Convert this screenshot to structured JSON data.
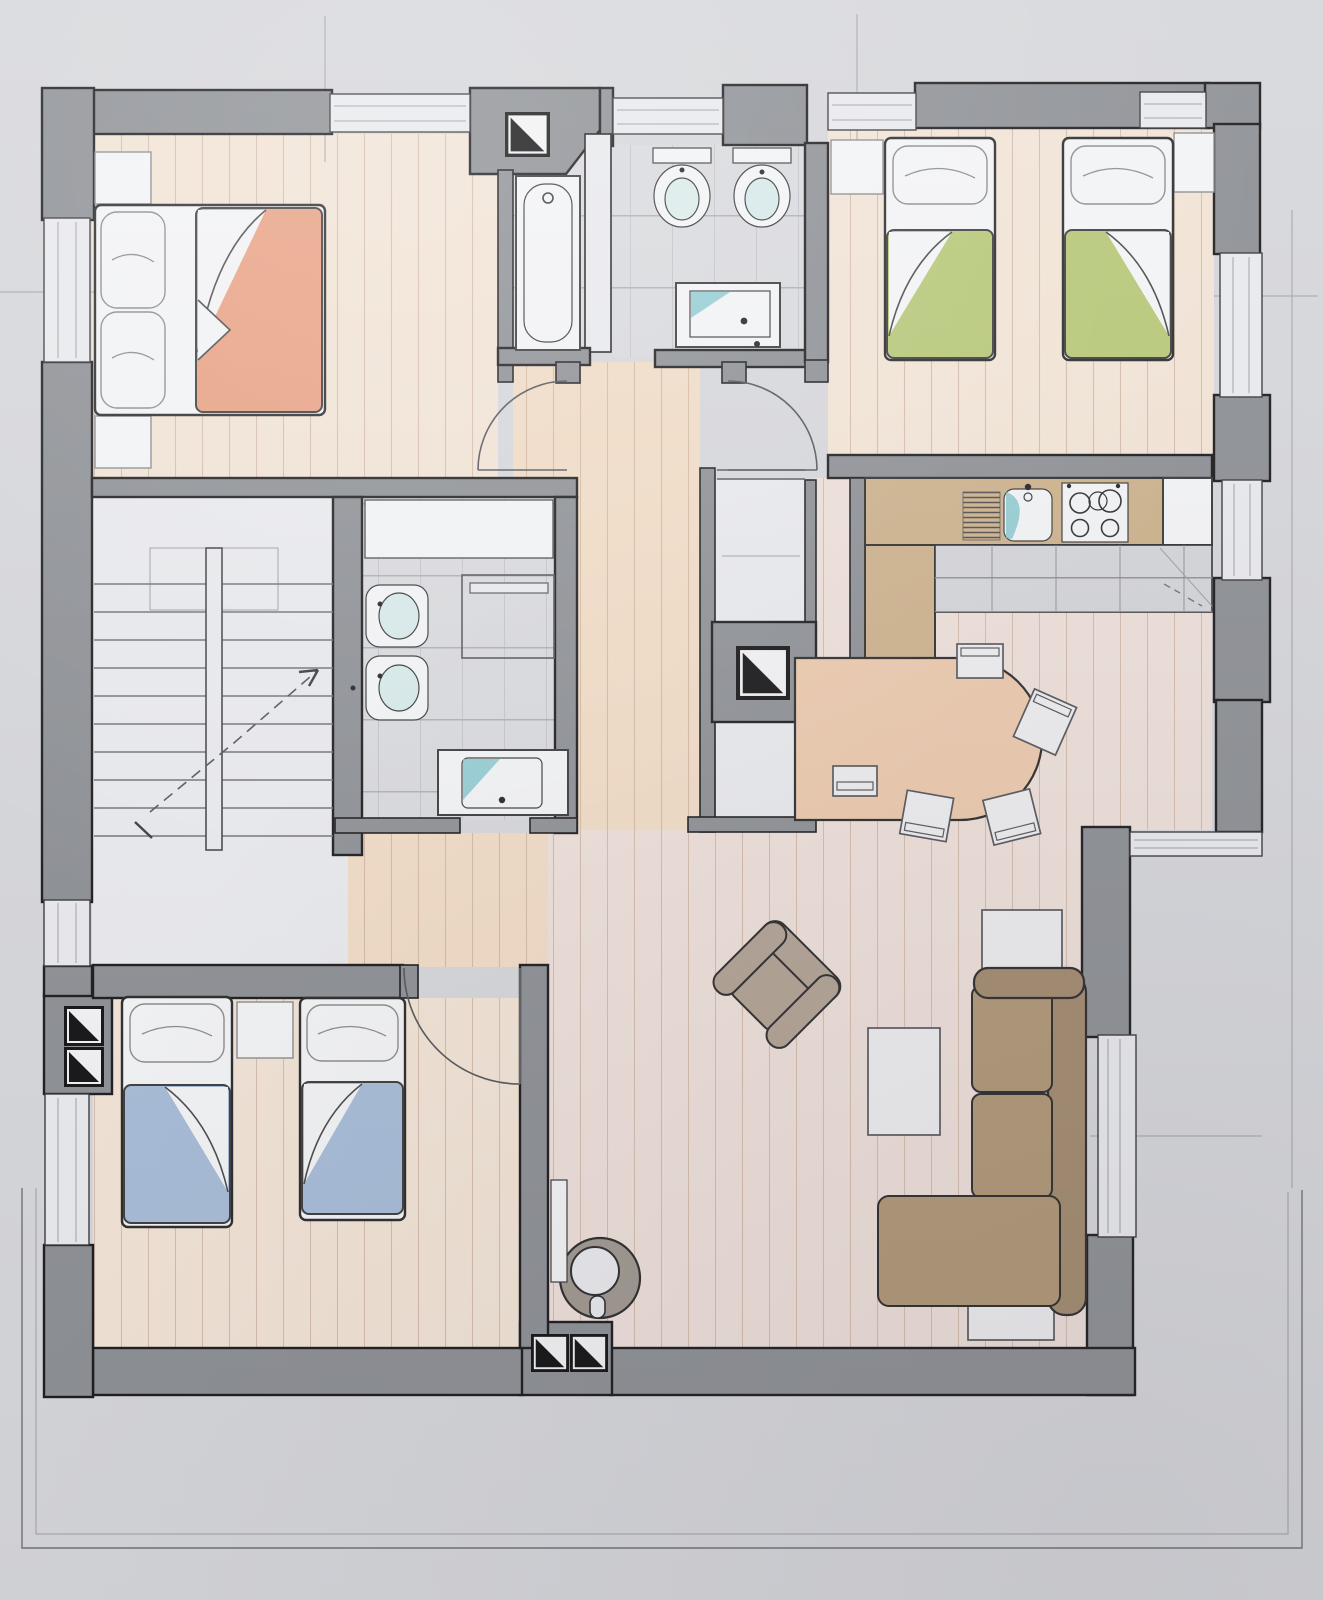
{
  "document": {
    "title": "Hand-drawn apartment floor plan",
    "medium": "pencil and colored-pencil sketch on gray paper",
    "view": "top-down plan of one residential floor with surrounding terrace outline"
  },
  "palette": {
    "paper": "#d6d7db",
    "wall": "#8d9095",
    "wall_outline": "#1c1c1e",
    "wood_warm": "#f1dcc6",
    "wood_light": "#f2e4d6",
    "wood_pink": "#eee0da",
    "tile": "#d9dade",
    "white_floor": "#e9eaee",
    "fixture": "#f3f4f6",
    "fixture_line": "#3a3a3c",
    "teal": "#76c0c8",
    "counter": "#cdb28c",
    "brick": "#d4d5d9",
    "orange": "#e9a183",
    "green": "#b7c878",
    "blue": "#a7bcd8",
    "sofa": "#a28a6e",
    "sofa_light": "#b09776",
    "armchair": "#b2a294",
    "table": "#eccaae",
    "chair": "#ededef",
    "stove_ring": "#a09890",
    "pencil": "#6f737a"
  },
  "rooms": [
    {
      "id": "bedroom-master",
      "label": "Bedroom with double bed",
      "floor": "wood planks",
      "furniture": [
        "double bed with orange blanket",
        "two pillows",
        "two nightstands"
      ],
      "windows": 2
    },
    {
      "id": "bathroom-main",
      "label": "Main bathroom",
      "floor": "gray tiles",
      "furniture": [
        "bathtub",
        "toilet",
        "bidet",
        "washbasin vanity"
      ],
      "wall_symbols": [
        "shaft marker"
      ]
    },
    {
      "id": "bedroom-green",
      "label": "Twin bedroom (green blankets)",
      "floor": "wood planks",
      "furniture": [
        "two single beds",
        "two nightstands"
      ],
      "windows": 2
    },
    {
      "id": "kitchen-dining",
      "label": "Kitchen and dining area",
      "floor": "wood planks",
      "furniture": [
        "L-shaped counter",
        "kitchen sink",
        "four-burner stove",
        "dish rack",
        "tiled counter front",
        "rounded dining table",
        "five chairs"
      ]
    },
    {
      "id": "hallway",
      "label": "Central hallway",
      "floor": "wood planks",
      "furniture": [
        "built-in wardrobe",
        "chimney shaft column"
      ],
      "doors": [
        "two swing doors at top",
        "wardrobe sliding door"
      ]
    },
    {
      "id": "stairwell",
      "label": "Staircase",
      "floor": "light screed",
      "furniture": [
        "two flights with central rail",
        "dashed walking line with arrow"
      ]
    },
    {
      "id": "bathroom-small",
      "label": "Shower bathroom",
      "floor": "gray tiles",
      "furniture": [
        "toilet",
        "bidet",
        "shower enclosure",
        "washbasin vanity",
        "laundry counter"
      ]
    },
    {
      "id": "bedroom-blue",
      "label": "Twin bedroom (blue blankets)",
      "floor": "wood planks",
      "furniture": [
        "two single beds",
        "nightstand"
      ],
      "wall_symbols": [
        "double shaft marker"
      ]
    },
    {
      "id": "living-room",
      "label": "Living room",
      "floor": "wood planks",
      "furniture": [
        "L-shaped sofa",
        "rotated armchair",
        "coffee table",
        "two side tables",
        "round wood stove",
        "radiator"
      ],
      "openings": [
        "balcony sliding door"
      ]
    },
    {
      "id": "terrace",
      "label": "Terrace / balcony outline around plan",
      "floor": "paper"
    }
  ],
  "symbols": {
    "shaft": "square with black diagonal half (chimney/ventilation shaft)",
    "window": "double-line band inside wall",
    "door": "quarter-circle swing arc",
    "stair_direction": "dashed line with arrowhead"
  }
}
